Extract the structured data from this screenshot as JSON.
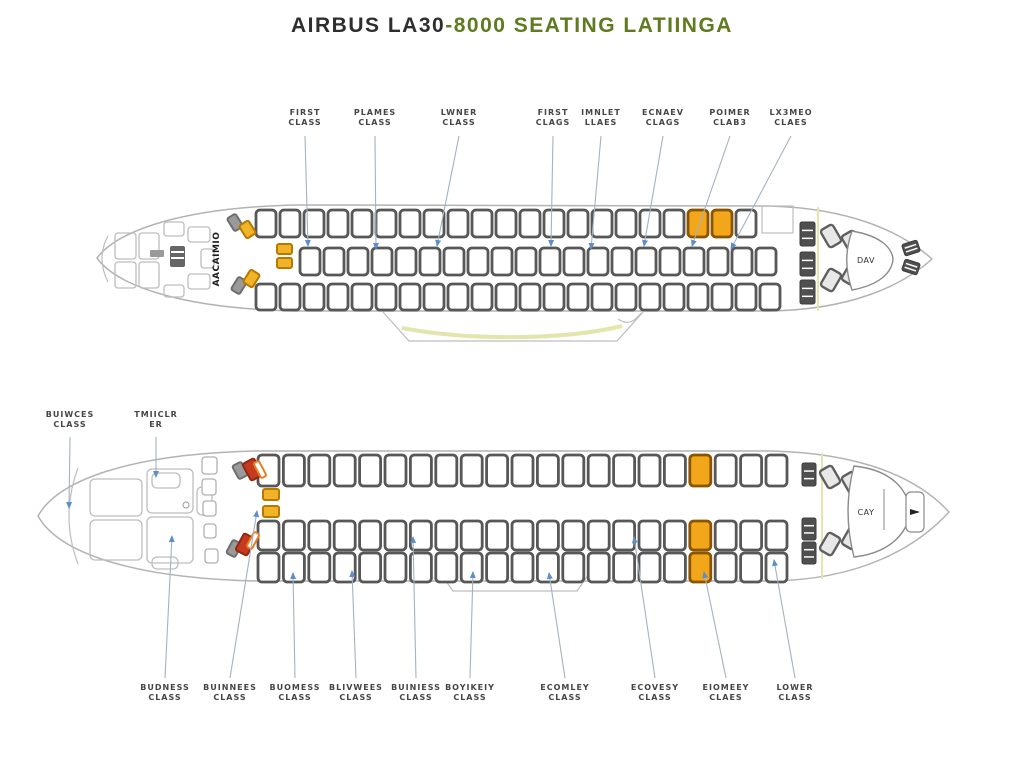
{
  "title": {
    "part1": "AIRBUS LA30",
    "part2": "-8000 SEATING LATIINGA"
  },
  "colors": {
    "accent_green": "#5f7a1f",
    "fuselage": "#b3b3b3",
    "sketch": "#bdbdbd",
    "seat_outline": "#575757",
    "highlight": "#f2a71b",
    "highlight_border": "#8a5400",
    "yellow_seat": "#f0b429",
    "yellow_border": "#b97700",
    "red_seat": "#c63a20",
    "orange_seat": "#e67e22",
    "gray_seat": "#9a9a9a",
    "dark_seat": "#4f4f4f",
    "leader": "#a4b2c2",
    "arrow": "#5d8ec9",
    "wing_band": "#dfe3a3",
    "separator": "#e4e6ae",
    "label_text": "#454545"
  },
  "top_aircraft": {
    "cockpit_text": "AACAIMIO",
    "center_text": "ГЭ+Ф",
    "tail_text": "DAV",
    "labels": [
      {
        "lines": [
          "FIRST",
          "CLASS"
        ],
        "x": 305,
        "tx": 308,
        "ty": 246
      },
      {
        "lines": [
          "PLAMES",
          "CLASS"
        ],
        "x": 375,
        "tx": 376,
        "ty": 249
      },
      {
        "lines": [
          "LWNER",
          "CLASS"
        ],
        "x": 459,
        "tx": 437,
        "ty": 246
      },
      {
        "lines": [
          "FIRST",
          "CLAGS"
        ],
        "x": 553,
        "tx": 551,
        "ty": 246
      },
      {
        "lines": [
          "IMNLET",
          "LLAES"
        ],
        "x": 601,
        "tx": 591,
        "ty": 249
      },
      {
        "lines": [
          "ECNAEV",
          "CLAGS"
        ],
        "x": 663,
        "tx": 644,
        "ty": 246
      },
      {
        "lines": [
          "POIMER",
          "CLAB3"
        ],
        "x": 730,
        "tx": 692,
        "ty": 246
      },
      {
        "lines": [
          "LX3MEO",
          "CLAES"
        ],
        "x": 791,
        "tx": 731,
        "ty": 249
      }
    ],
    "rows": [
      {
        "x": 256,
        "y": 210,
        "w": 20,
        "h": 27,
        "pitch": 24,
        "count": 21,
        "highlights": [
          18,
          19
        ]
      },
      {
        "x": 300,
        "y": 248,
        "w": 20,
        "h": 27,
        "pitch": 24,
        "count": 20,
        "highlights": []
      },
      {
        "x": 256,
        "y": 284,
        "w": 20,
        "h": 26,
        "pitch": 24,
        "count": 22,
        "highlights": []
      }
    ],
    "special_seats": [
      {
        "type": "gray",
        "x": 230,
        "y": 215,
        "w": 10,
        "h": 15,
        "rot": -32
      },
      {
        "type": "yellow",
        "x": 242,
        "y": 222,
        "w": 11,
        "h": 15,
        "rot": -32
      },
      {
        "type": "gray",
        "x": 234,
        "y": 278,
        "w": 10,
        "h": 15,
        "rot": 32
      },
      {
        "type": "yellow",
        "x": 246,
        "y": 271,
        "w": 11,
        "h": 15,
        "rot": 32
      },
      {
        "type": "yellow",
        "x": 277,
        "y": 244,
        "w": 15,
        "h": 10,
        "rot": 0
      },
      {
        "type": "yellow",
        "x": 277,
        "y": 258,
        "w": 15,
        "h": 10,
        "rot": 0
      }
    ]
  },
  "bottom_aircraft": {
    "tail_text": "CAY",
    "side_labels": [
      {
        "lines": [
          "BUIWCES",
          "CLASS"
        ],
        "x": 70,
        "y": 410,
        "tx": 69,
        "ty": 508
      },
      {
        "lines": [
          "TMIICLR",
          "ER"
        ],
        "x": 156,
        "y": 410,
        "tx": 156,
        "ty": 477
      }
    ],
    "labels": [
      {
        "lines": [
          "BUDNESS",
          "CLASS"
        ],
        "x": 165,
        "tx": 172,
        "ty": 536
      },
      {
        "lines": [
          "BUINNEES",
          "CLASS"
        ],
        "x": 230,
        "tx": 257,
        "ty": 511
      },
      {
        "lines": [
          "BUOMESS",
          "CLASS"
        ],
        "x": 295,
        "tx": 293,
        "ty": 573
      },
      {
        "lines": [
          "BLIVWEES",
          "CLASS"
        ],
        "x": 356,
        "tx": 352,
        "ty": 571
      },
      {
        "lines": [
          "BUINIESS",
          "CLASS"
        ],
        "x": 416,
        "tx": 413,
        "ty": 537
      },
      {
        "lines": [
          "BOYIKEIY",
          "CLASS"
        ],
        "x": 470,
        "tx": 473,
        "ty": 572
      },
      {
        "lines": [
          "ECOMLEY",
          "CLASS"
        ],
        "x": 565,
        "tx": 549,
        "ty": 573
      },
      {
        "lines": [
          "ECOVESY",
          "CLASS"
        ],
        "x": 655,
        "tx": 634,
        "ty": 537
      },
      {
        "lines": [
          "EIOMEEY",
          "CLAES"
        ],
        "x": 726,
        "tx": 704,
        "ty": 572
      },
      {
        "lines": [
          "LOWER",
          "CLASS"
        ],
        "x": 795,
        "tx": 774,
        "ty": 560
      }
    ],
    "rows": [
      {
        "x": 258,
        "y": 455,
        "w": 21,
        "h": 31,
        "pitch": 25.4,
        "count": 21,
        "highlights": [
          17
        ]
      },
      {
        "x": 258,
        "y": 521,
        "w": 21,
        "h": 29,
        "pitch": 25.4,
        "count": 21,
        "highlights": [
          17
        ]
      },
      {
        "x": 258,
        "y": 553,
        "w": 21,
        "h": 29,
        "pitch": 25.4,
        "count": 21,
        "highlights": [
          17
        ]
      }
    ],
    "special_seats": [
      {
        "type": "gray",
        "x": 235,
        "y": 463,
        "w": 10,
        "h": 15,
        "rot": -28
      },
      {
        "type": "red",
        "x": 246,
        "y": 460,
        "w": 13,
        "h": 19,
        "rot": -28
      },
      {
        "type": "orange",
        "x": 257,
        "y": 461,
        "w": 6,
        "h": 17,
        "rot": -28
      },
      {
        "type": "gray",
        "x": 229,
        "y": 541,
        "w": 10,
        "h": 15,
        "rot": 28
      },
      {
        "type": "red",
        "x": 239,
        "y": 535,
        "w": 13,
        "h": 19,
        "rot": 28
      },
      {
        "type": "orange",
        "x": 250,
        "y": 532,
        "w": 6,
        "h": 17,
        "rot": 28
      },
      {
        "type": "yellow",
        "x": 263,
        "y": 489,
        "w": 16,
        "h": 11,
        "rot": 0
      },
      {
        "type": "yellow",
        "x": 263,
        "y": 506,
        "w": 16,
        "h": 11,
        "rot": 0
      }
    ]
  }
}
